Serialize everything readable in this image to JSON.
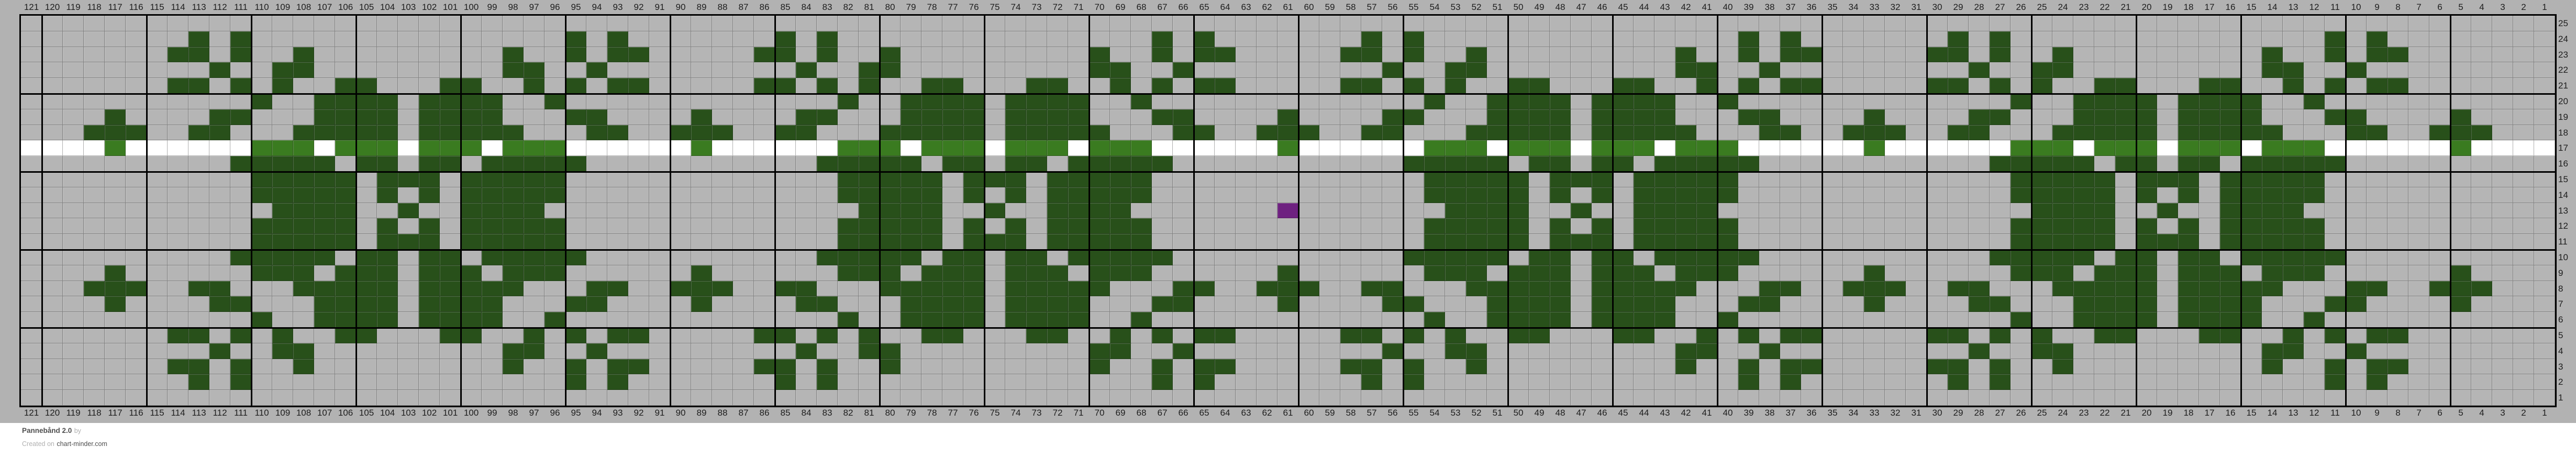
{
  "footer": {
    "title": "Pannebånd 2.0",
    "by_label": "by",
    "created_prefix": "Created on",
    "site": "chart-minder.com"
  },
  "chart_data": {
    "type": "heatmap",
    "title": "Pannebånd 2.0 knitting colorwork chart",
    "grid_columns": 121,
    "grid_rows": 25,
    "legend_position": "none",
    "grid_on": true,
    "column_labels": [
      121,
      120,
      119,
      118,
      117,
      116,
      115,
      114,
      113,
      112,
      111,
      110,
      109,
      108,
      107,
      106,
      105,
      104,
      103,
      102,
      101,
      100,
      99,
      98,
      97,
      96,
      95,
      94,
      93,
      92,
      91,
      90,
      89,
      88,
      87,
      86,
      85,
      84,
      83,
      82,
      81,
      80,
      79,
      78,
      77,
      76,
      75,
      74,
      73,
      72,
      71,
      70,
      69,
      68,
      67,
      66,
      65,
      64,
      63,
      62,
      61,
      60,
      59,
      58,
      57,
      56,
      55,
      54,
      53,
      52,
      51,
      50,
      49,
      48,
      47,
      46,
      45,
      44,
      43,
      42,
      41,
      40,
      39,
      38,
      37,
      36,
      35,
      34,
      33,
      32,
      31,
      30,
      29,
      28,
      27,
      26,
      25,
      24,
      23,
      22,
      21,
      20,
      19,
      18,
      17,
      16,
      15,
      14,
      13,
      12,
      11,
      10,
      9,
      8,
      7,
      6,
      5,
      4,
      3,
      2,
      1
    ],
    "row_labels": [
      25,
      24,
      23,
      22,
      21,
      20,
      19,
      18,
      17,
      16,
      15,
      14,
      13,
      12,
      11,
      10,
      9,
      8,
      7,
      6,
      5,
      4,
      3,
      2,
      1
    ],
    "colors": {
      "canvas_gray": "#b2b2b2",
      "cell_gray": "#b5b5b5",
      "dark_green": "#28501a",
      "light_green": "#3a7b20",
      "white": "#ffffff",
      "purple": "#6e2180",
      "thick_line": "#000000",
      "label_text": "#1d1d1d"
    },
    "bold_line_every": 5,
    "rows_data": [
      {
        "row": 25,
        "bg": "gray",
        "dark": []
      },
      {
        "row": 24,
        "bg": "gray",
        "dark": [
          113,
          111,
          95,
          93,
          85,
          83,
          67,
          65,
          57,
          55,
          39,
          37,
          29,
          27,
          11,
          9
        ]
      },
      {
        "row": 23,
        "bg": "gray",
        "dark": [
          114,
          113,
          111,
          108,
          98,
          95,
          93,
          92,
          86,
          85,
          83,
          80,
          70,
          67,
          65,
          64,
          58,
          57,
          55,
          52,
          42,
          39,
          37,
          36,
          30,
          29,
          27,
          24,
          14,
          11,
          9,
          8
        ]
      },
      {
        "row": 22,
        "bg": "gray",
        "dark": [
          112,
          109,
          108,
          98,
          97,
          94,
          84,
          81,
          80,
          70,
          69,
          66,
          56,
          53,
          52,
          42,
          41,
          38,
          28,
          25,
          24,
          14,
          13,
          10
        ]
      },
      {
        "row": 21,
        "bg": "gray",
        "dark": [
          114,
          113,
          111,
          109,
          106,
          105,
          101,
          100,
          97,
          95,
          93,
          92,
          86,
          85,
          83,
          81,
          78,
          77,
          73,
          72,
          69,
          67,
          65,
          64,
          58,
          57,
          55,
          53,
          50,
          49,
          45,
          44,
          41,
          39,
          37,
          36,
          30,
          29,
          27,
          25,
          22,
          21,
          17,
          16,
          13,
          11,
          9,
          8
        ]
      },
      {
        "row": 20,
        "bg": "gray",
        "dark": [
          110,
          107,
          106,
          105,
          104,
          102,
          101,
          100,
          99,
          96,
          82,
          79,
          78,
          77,
          76,
          74,
          73,
          72,
          71,
          68,
          54,
          51,
          50,
          49,
          48,
          46,
          45,
          44,
          43,
          40,
          26,
          23,
          22,
          21,
          20,
          18,
          17,
          16,
          15,
          12
        ]
      },
      {
        "row": 19,
        "bg": "gray",
        "dark": [
          117,
          112,
          111,
          107,
          106,
          105,
          104,
          102,
          101,
          100,
          99,
          95,
          94,
          89,
          84,
          83,
          79,
          78,
          77,
          76,
          74,
          73,
          72,
          71,
          67,
          66,
          61,
          56,
          55,
          51,
          50,
          49,
          48,
          46,
          45,
          44,
          43,
          39,
          38,
          33,
          28,
          27,
          23,
          22,
          21,
          20,
          18,
          17,
          16,
          15,
          11,
          10,
          5
        ]
      },
      {
        "row": 18,
        "bg": "gray",
        "dark": [
          118,
          117,
          116,
          113,
          112,
          108,
          107,
          106,
          105,
          104,
          102,
          101,
          100,
          99,
          98,
          94,
          93,
          90,
          89,
          88,
          85,
          84,
          80,
          79,
          78,
          77,
          76,
          74,
          73,
          72,
          71,
          70,
          66,
          65,
          62,
          61,
          60,
          57,
          56,
          52,
          51,
          50,
          49,
          48,
          46,
          45,
          44,
          43,
          42,
          38,
          37,
          34,
          33,
          32,
          29,
          28,
          24,
          23,
          22,
          21,
          20,
          18,
          17,
          16,
          15,
          14,
          10,
          9,
          6,
          5,
          4
        ]
      },
      {
        "row": 17,
        "bg": "white",
        "light": [
          117,
          110,
          109,
          108,
          106,
          105,
          104,
          102,
          101,
          100,
          98,
          97,
          96,
          89,
          82,
          81,
          80,
          78,
          77,
          76,
          74,
          73,
          72,
          70,
          69,
          68,
          61,
          54,
          53,
          52,
          50,
          49,
          48,
          46,
          45,
          44,
          42,
          41,
          40,
          33,
          26,
          25,
          24,
          22,
          21,
          20,
          18,
          17,
          16,
          14,
          13,
          12,
          5
        ]
      },
      {
        "row": 16,
        "bg": "gray",
        "dark": [
          111,
          110,
          109,
          108,
          107,
          105,
          104,
          102,
          101,
          99,
          98,
          97,
          96,
          95,
          83,
          82,
          81,
          80,
          79,
          77,
          76,
          74,
          73,
          71,
          70,
          69,
          68,
          67,
          55,
          54,
          53,
          52,
          51,
          49,
          48,
          46,
          45,
          43,
          42,
          41,
          40,
          39,
          27,
          26,
          25,
          24,
          23,
          21,
          20,
          18,
          17,
          15,
          14,
          13,
          12,
          11
        ]
      },
      {
        "row": 15,
        "bg": "gray",
        "dark": [
          110,
          109,
          108,
          107,
          106,
          104,
          103,
          102,
          100,
          99,
          98,
          97,
          96,
          82,
          81,
          80,
          79,
          78,
          76,
          75,
          74,
          72,
          71,
          70,
          69,
          68,
          54,
          53,
          52,
          51,
          50,
          48,
          47,
          46,
          44,
          43,
          42,
          41,
          40,
          26,
          25,
          24,
          23,
          22,
          20,
          19,
          18,
          16,
          15,
          14,
          13,
          12
        ]
      },
      {
        "row": 14,
        "bg": "gray",
        "dark": [
          110,
          109,
          108,
          107,
          106,
          104,
          102,
          100,
          99,
          98,
          97,
          96,
          82,
          81,
          80,
          79,
          78,
          76,
          74,
          72,
          71,
          70,
          69,
          68,
          54,
          53,
          52,
          51,
          50,
          48,
          46,
          44,
          43,
          42,
          41,
          40,
          26,
          25,
          24,
          23,
          22,
          20,
          18,
          16,
          15,
          14,
          13,
          12
        ]
      },
      {
        "row": 13,
        "bg": "gray",
        "dark": [
          109,
          108,
          107,
          106,
          103,
          100,
          99,
          98,
          97,
          81,
          80,
          79,
          78,
          75,
          72,
          71,
          70,
          69,
          53,
          52,
          51,
          50,
          47,
          44,
          43,
          42,
          41,
          25,
          24,
          23,
          22,
          19,
          16,
          15,
          14,
          13
        ],
        "purple": [
          61
        ]
      },
      {
        "row": 12,
        "bg": "gray",
        "dark": [
          110,
          109,
          108,
          107,
          106,
          104,
          102,
          100,
          99,
          98,
          97,
          96,
          82,
          81,
          80,
          79,
          78,
          76,
          74,
          72,
          71,
          70,
          69,
          68,
          54,
          53,
          52,
          51,
          50,
          48,
          46,
          44,
          43,
          42,
          41,
          40,
          26,
          25,
          24,
          23,
          22,
          20,
          18,
          16,
          15,
          14,
          13,
          12
        ]
      },
      {
        "row": 11,
        "bg": "gray",
        "dark": [
          110,
          109,
          108,
          107,
          106,
          104,
          103,
          102,
          100,
          99,
          98,
          97,
          96,
          82,
          81,
          80,
          79,
          78,
          76,
          75,
          74,
          72,
          71,
          70,
          69,
          68,
          54,
          53,
          52,
          51,
          50,
          48,
          47,
          46,
          44,
          43,
          42,
          41,
          40,
          26,
          25,
          24,
          23,
          22,
          20,
          19,
          18,
          16,
          15,
          14,
          13,
          12
        ]
      },
      {
        "row": 10,
        "bg": "gray",
        "dark": [
          111,
          110,
          109,
          108,
          107,
          105,
          104,
          102,
          101,
          99,
          98,
          97,
          96,
          95,
          83,
          82,
          81,
          80,
          79,
          77,
          76,
          74,
          73,
          71,
          70,
          69,
          68,
          67,
          55,
          54,
          53,
          52,
          51,
          49,
          48,
          46,
          45,
          43,
          42,
          41,
          40,
          39,
          27,
          26,
          25,
          24,
          23,
          21,
          20,
          18,
          17,
          15,
          14,
          13,
          12,
          11
        ]
      },
      {
        "row": 9,
        "bg": "gray",
        "dark": [
          117,
          110,
          109,
          108,
          106,
          105,
          104,
          102,
          101,
          100,
          98,
          97,
          96,
          89,
          82,
          81,
          80,
          78,
          77,
          76,
          74,
          73,
          72,
          70,
          69,
          68,
          61,
          54,
          53,
          52,
          50,
          49,
          48,
          46,
          45,
          44,
          42,
          41,
          40,
          33,
          26,
          25,
          24,
          22,
          21,
          20,
          18,
          17,
          16,
          14,
          13,
          12,
          5
        ]
      },
      {
        "row": 8,
        "bg": "gray",
        "dark": [
          118,
          117,
          116,
          113,
          112,
          108,
          107,
          106,
          105,
          104,
          102,
          101,
          100,
          99,
          98,
          94,
          93,
          90,
          89,
          88,
          85,
          84,
          80,
          79,
          78,
          77,
          76,
          74,
          73,
          72,
          71,
          70,
          66,
          65,
          62,
          61,
          60,
          57,
          56,
          52,
          51,
          50,
          49,
          48,
          46,
          45,
          44,
          43,
          42,
          38,
          37,
          34,
          33,
          32,
          29,
          28,
          24,
          23,
          22,
          21,
          20,
          18,
          17,
          16,
          15,
          14,
          10,
          9,
          6,
          5,
          4
        ]
      },
      {
        "row": 7,
        "bg": "gray",
        "dark": [
          117,
          112,
          111,
          107,
          106,
          105,
          104,
          102,
          101,
          100,
          99,
          95,
          94,
          89,
          84,
          83,
          79,
          78,
          77,
          76,
          74,
          73,
          72,
          71,
          67,
          66,
          61,
          56,
          55,
          51,
          50,
          49,
          48,
          46,
          45,
          44,
          43,
          39,
          38,
          33,
          28,
          27,
          23,
          22,
          21,
          20,
          18,
          17,
          16,
          15,
          11,
          10,
          5
        ]
      },
      {
        "row": 6,
        "bg": "gray",
        "dark": [
          110,
          107,
          106,
          105,
          104,
          102,
          101,
          100,
          99,
          96,
          82,
          79,
          78,
          77,
          76,
          74,
          73,
          72,
          71,
          68,
          54,
          51,
          50,
          49,
          48,
          46,
          45,
          44,
          43,
          40,
          26,
          23,
          22,
          21,
          20,
          18,
          17,
          16,
          15,
          12
        ]
      },
      {
        "row": 5,
        "bg": "gray",
        "dark": [
          114,
          113,
          111,
          109,
          106,
          105,
          101,
          100,
          97,
          95,
          93,
          92,
          86,
          85,
          83,
          81,
          78,
          77,
          73,
          72,
          69,
          67,
          65,
          64,
          58,
          57,
          55,
          53,
          50,
          49,
          45,
          44,
          41,
          39,
          37,
          36,
          30,
          29,
          27,
          25,
          22,
          21,
          17,
          16,
          13,
          11,
          9,
          8
        ]
      },
      {
        "row": 4,
        "bg": "gray",
        "dark": [
          112,
          109,
          108,
          98,
          97,
          94,
          84,
          81,
          80,
          70,
          69,
          66,
          56,
          53,
          52,
          42,
          41,
          38,
          28,
          25,
          24,
          14,
          13,
          10
        ]
      },
      {
        "row": 3,
        "bg": "gray",
        "dark": [
          114,
          113,
          111,
          108,
          98,
          95,
          93,
          92,
          86,
          85,
          83,
          80,
          70,
          67,
          65,
          64,
          58,
          57,
          55,
          52,
          42,
          39,
          37,
          36,
          30,
          29,
          27,
          24,
          14,
          11,
          9,
          8
        ]
      },
      {
        "row": 2,
        "bg": "gray",
        "dark": [
          113,
          111,
          95,
          93,
          85,
          83,
          67,
          65,
          57,
          55,
          39,
          37,
          29,
          27,
          11,
          9
        ]
      },
      {
        "row": 1,
        "bg": "gray",
        "dark": []
      }
    ]
  }
}
